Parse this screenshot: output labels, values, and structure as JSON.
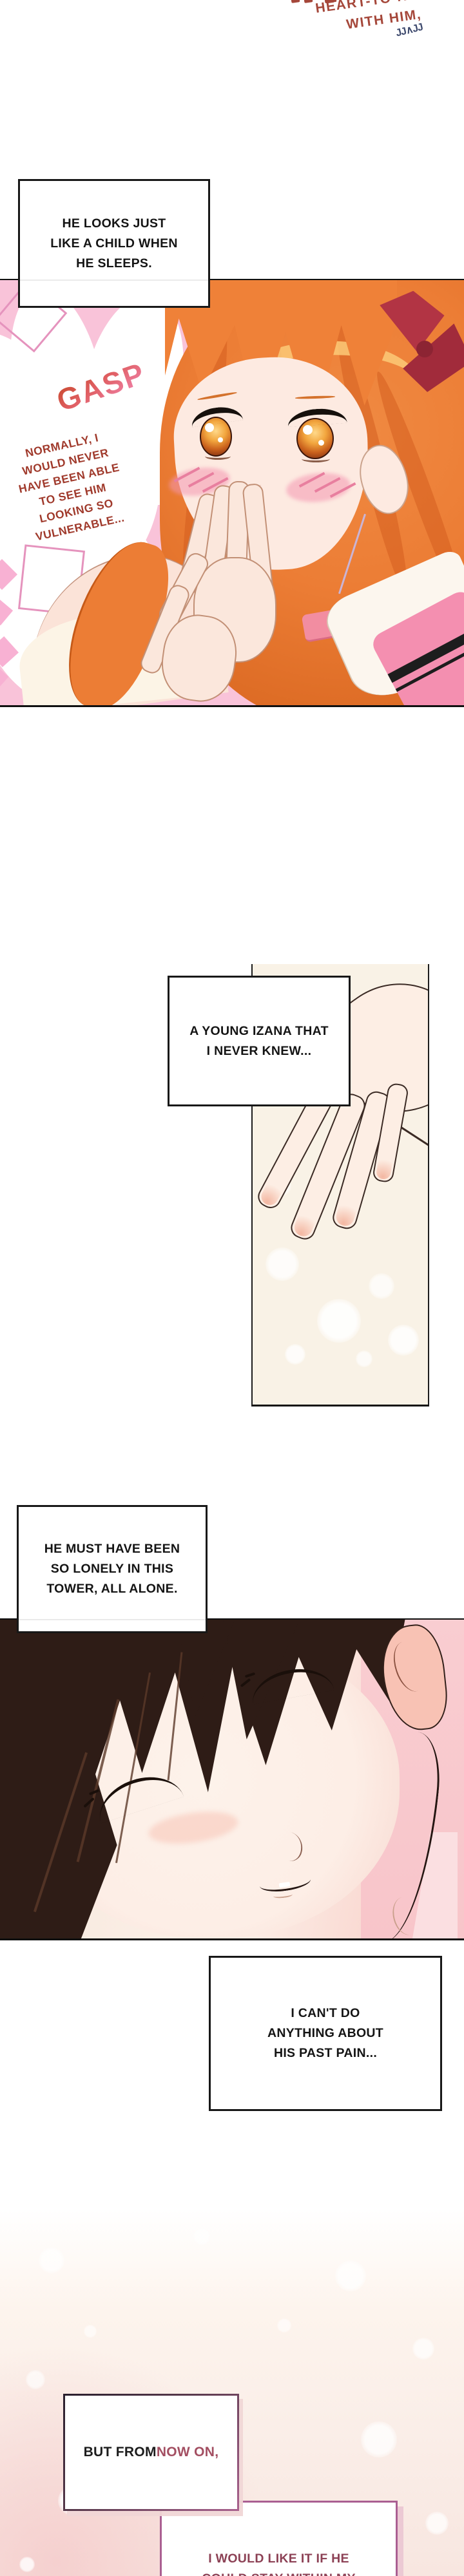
{
  "header": {
    "line1": "HEART-TO-HEART",
    "line2": "WITH HIM,",
    "scribble": "JJ∧JJ",
    "text_color": "#a5473a",
    "scribble_color": "#3e4a6e"
  },
  "bubble1": {
    "lines": [
      "HE LOOKS JUST",
      "LIKE A CHILD WHEN",
      "HE SLEEPS."
    ]
  },
  "panel1": {
    "sfx": "GASP",
    "sfx_color_top": "#c8492c",
    "sfx_color_bottom": "#f083ab",
    "monologue": [
      "NORMALLY, I",
      "WOULD NEVER",
      "HAVE BEEN ABLE",
      "TO SEE HIM",
      "LOOKING SO",
      "VULNERABLE..."
    ],
    "monologue_color": "#a03a2c",
    "panel_bg": "#f9c3d9"
  },
  "bubble2": {
    "lines": [
      "A YOUNG IZANA THAT",
      "I NEVER KNEW..."
    ]
  },
  "bubble3": {
    "lines": [
      "HE MUST HAVE BEEN",
      "SO LONELY IN THIS",
      "TOWER, ALL ALONE."
    ]
  },
  "bubble4": {
    "lines": [
      "I CAN'T DO",
      "ANYTHING ABOUT",
      "HIS PAST PAIN..."
    ]
  },
  "bottom": {
    "box_a_prefix": "BUT FROM ",
    "box_a_accent": "NOW ON,",
    "box_a_accent_color": "#a34f62",
    "box_b_line1": "I WOULD LIKE IT IF HE",
    "box_b_line2": "COULD STAY WITHIN MY",
    "box_b_text_color": "#8c4155"
  }
}
